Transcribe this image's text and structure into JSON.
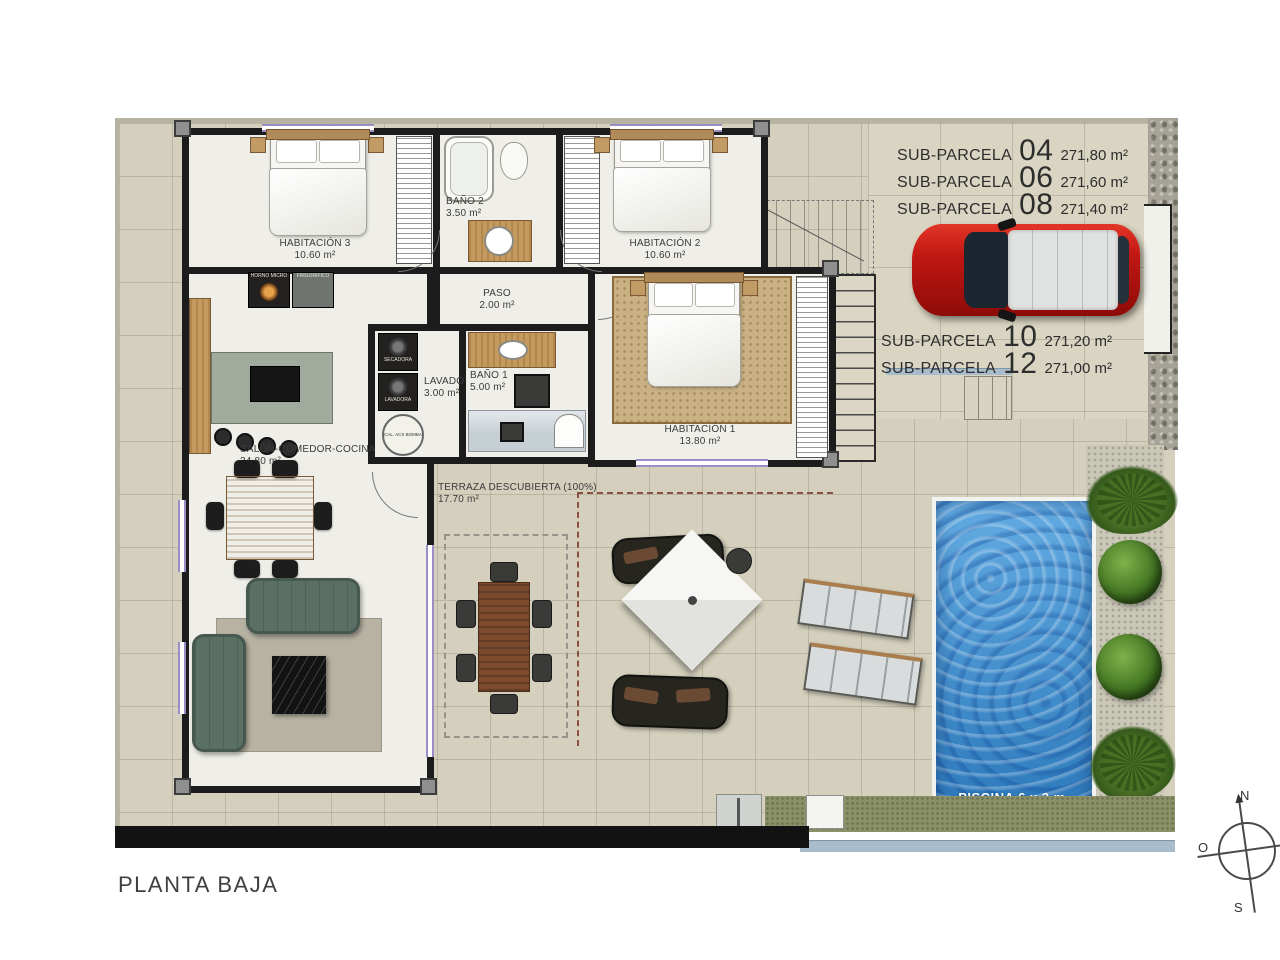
{
  "title": "PLANTA BAJA",
  "sub_parcelas": [
    {
      "label": "SUB-PARCELA",
      "number": "04",
      "area": "271,80 m²"
    },
    {
      "label": "SUB-PARCELA",
      "number": "06",
      "area": "271,60 m²"
    },
    {
      "label": "SUB-PARCELA",
      "number": "08",
      "area": "271,40 m²"
    },
    {
      "label": "SUB-PARCELA",
      "number": "10",
      "area": "271,20 m²"
    },
    {
      "label": "SUB-PARCELA",
      "number": "12",
      "area": "271,00 m²"
    }
  ],
  "rooms": {
    "habitacion3": {
      "name": "HABITACIÓN 3",
      "area": "10.60 m²"
    },
    "bano2": {
      "name": "BAÑO 2",
      "area": "3.50 m²"
    },
    "habitacion2": {
      "name": "HABITACIÓN 2",
      "area": "10.60 m²"
    },
    "paso": {
      "name": "PASO",
      "area": "2.00 m²"
    },
    "lavado": {
      "name": "LAVADO",
      "area": "3.00 m²"
    },
    "bano1": {
      "name": "BAÑO 1",
      "area": "5.00 m²"
    },
    "habitacion1": {
      "name": "HABITACIÓN 1",
      "area": "13.80 m²"
    },
    "salon": {
      "name": "SALÓN-COMEDOR-COCINA",
      "area": "34.80 m²"
    },
    "terraza": {
      "name": "TERRAZA DESCUBIERTA (100%)",
      "area": "17.70 m²"
    }
  },
  "pool": {
    "label": "PISCINA 6 x 3 m."
  },
  "appliances": {
    "horno": "HORNO MICRO",
    "frigorifico": "FRIGORÍFICO",
    "secadora": "SECADORA",
    "lavadora": "LAVADORA",
    "caldera": "CAL. ACS BOMBA"
  },
  "compass": {
    "north": "N",
    "west": "O",
    "south": "S"
  },
  "colors": {
    "pool_blue": "#3e92d4",
    "car_red": "#c21d14",
    "window_accent": "#9c8cc8",
    "sofa_green": "#5a7065"
  }
}
